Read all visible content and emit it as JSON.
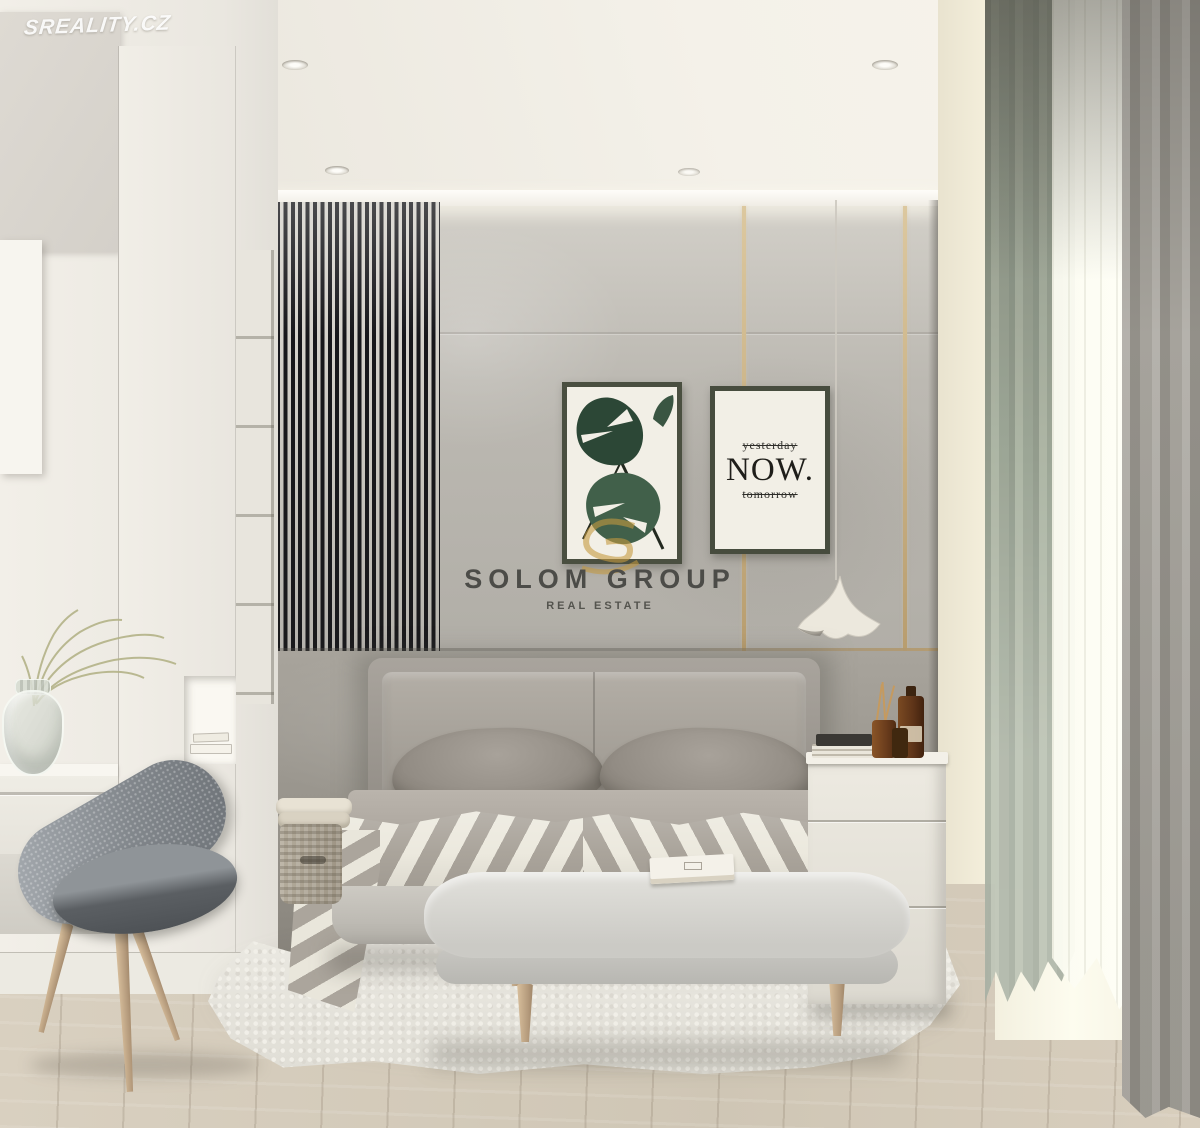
{
  "watermark": {
    "text": "SREALITY.CZ"
  },
  "branding": {
    "title": "SOLOM GROUP",
    "subtitle": "REAL ESTATE"
  },
  "poster_now": {
    "line_top": "yesterday",
    "line_main": "NOW.",
    "line_bottom": "tomorrow"
  },
  "palette": {
    "ceiling": "#f0ece3",
    "wall-upper": "#bfbcb4",
    "wall-lower": "#9b968e",
    "slat-dark": "#17171b",
    "slat-light": "#d5d2cb",
    "gold": "#c4a878",
    "poster-frame": "#4a4f40",
    "poster-bg": "#f2efe6",
    "leaf-dark": "#2c4736",
    "leaf-light": "#41604a",
    "brand-ink": "#4c4c48",
    "bed-fabric": "#a19b93",
    "duvet-light": "#ece9de",
    "duvet-dark": "#aaa49b",
    "bench": "#d7d6d1",
    "rug": "#e7e5de",
    "floor": "#d4caba",
    "wood-leg": "#c9ae88",
    "white-furniture": "#efece4",
    "curtain-gray": "#a4a19b",
    "curtain-green": "#97a191",
    "window-glow": "#fcfbee",
    "chair-fabric": "#82878c",
    "bottle-amber": "#6a3c1c",
    "monogram-gold": "#c49a3f"
  }
}
